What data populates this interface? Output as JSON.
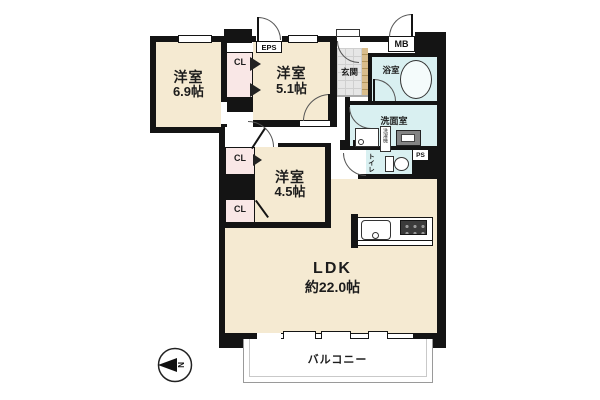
{
  "plan": {
    "rooms": [
      {
        "id": "room-6-9",
        "name": "洋室",
        "size": "6.9帖"
      },
      {
        "id": "room-5-1",
        "name": "洋室",
        "size": "5.1帖"
      },
      {
        "id": "room-4-5",
        "name": "洋室",
        "size": "4.5帖"
      },
      {
        "id": "ldk",
        "name": "LDK",
        "size": "約22.0帖"
      }
    ],
    "spaces": {
      "genkan": "玄関",
      "bath": "浴室",
      "washroom": "洗面室",
      "toilet": "トイレ",
      "balcony": "バルコニー"
    },
    "closets": {
      "cl_between_rooms": "CL",
      "cl_upper": "CL",
      "cl_lower": "CL"
    },
    "shafts": {
      "eps": "EPS",
      "mb": "MB",
      "ps": "PS"
    },
    "fixtures": {
      "washer": "洗濯機"
    },
    "compass": {
      "north": "N"
    },
    "colors": {
      "room_fill": "#f5ead2",
      "wet_fill": "#d9f0f1",
      "closet_fill": "#f9e7e6",
      "wall": "#141414",
      "genkan_tile": "#e6e6e6",
      "shoe_cabinet": "#d9bd8c"
    }
  }
}
